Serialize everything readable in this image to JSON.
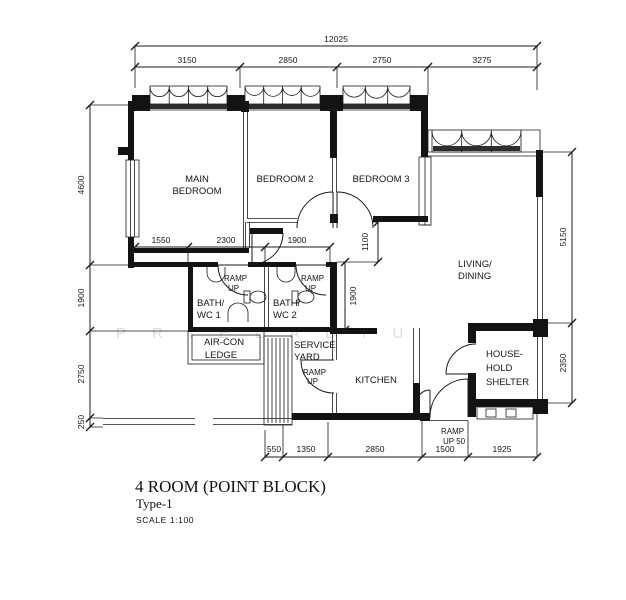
{
  "title": {
    "name": "4 ROOM (POINT BLOCK)",
    "type": "Type-1",
    "scale": "SCALE  1:100"
  },
  "rooms": {
    "main_bedroom": {
      "l1": "MAIN",
      "l2": "BEDROOM"
    },
    "bedroom2": "BEDROOM 2",
    "bedroom3": "BEDROOM 3",
    "living": {
      "l1": "LIVING/",
      "l2": "DINING"
    },
    "bath1": {
      "l1": "BATH/",
      "l2": "WC 1"
    },
    "bath2": {
      "l1": "BATH/",
      "l2": "WC 2"
    },
    "aircon": {
      "l1": "AIR-CON",
      "l2": "LEDGE"
    },
    "service_yard": {
      "l1": "SERVICE",
      "l2": "YARD"
    },
    "kitchen": "KITCHEN",
    "shelter": {
      "l1": "HOUSE-",
      "l2": "HOLD",
      "l3": "SHELTER"
    }
  },
  "ramps": {
    "bath1": {
      "l1": "RAMP",
      "l2": "UP"
    },
    "bath2": {
      "l1": "RAMP",
      "l2": "UP"
    },
    "service_yard": {
      "l1": "RAMP",
      "l2": "UP"
    },
    "entrance": {
      "l1": "RAMP",
      "l2": "UP 50"
    }
  },
  "dimensions": {
    "overall_width": "12025",
    "top": [
      "3150",
      "2850",
      "2750",
      "3275"
    ],
    "left": [
      "4600",
      "1900",
      "2750",
      "250"
    ],
    "right": [
      "5150",
      "2350"
    ],
    "bottom": [
      "550",
      "1350",
      "2850",
      "1500",
      "1925"
    ],
    "inner_horizontal": [
      "1550",
      "2300",
      "1900"
    ],
    "inner_vertical": [
      "1100",
      "1900"
    ]
  },
  "watermark": "PRIELADIU",
  "colors": {
    "ink": "#1b1b1b",
    "wall_fill": "#131313",
    "watermark": "#c2c2c2"
  }
}
